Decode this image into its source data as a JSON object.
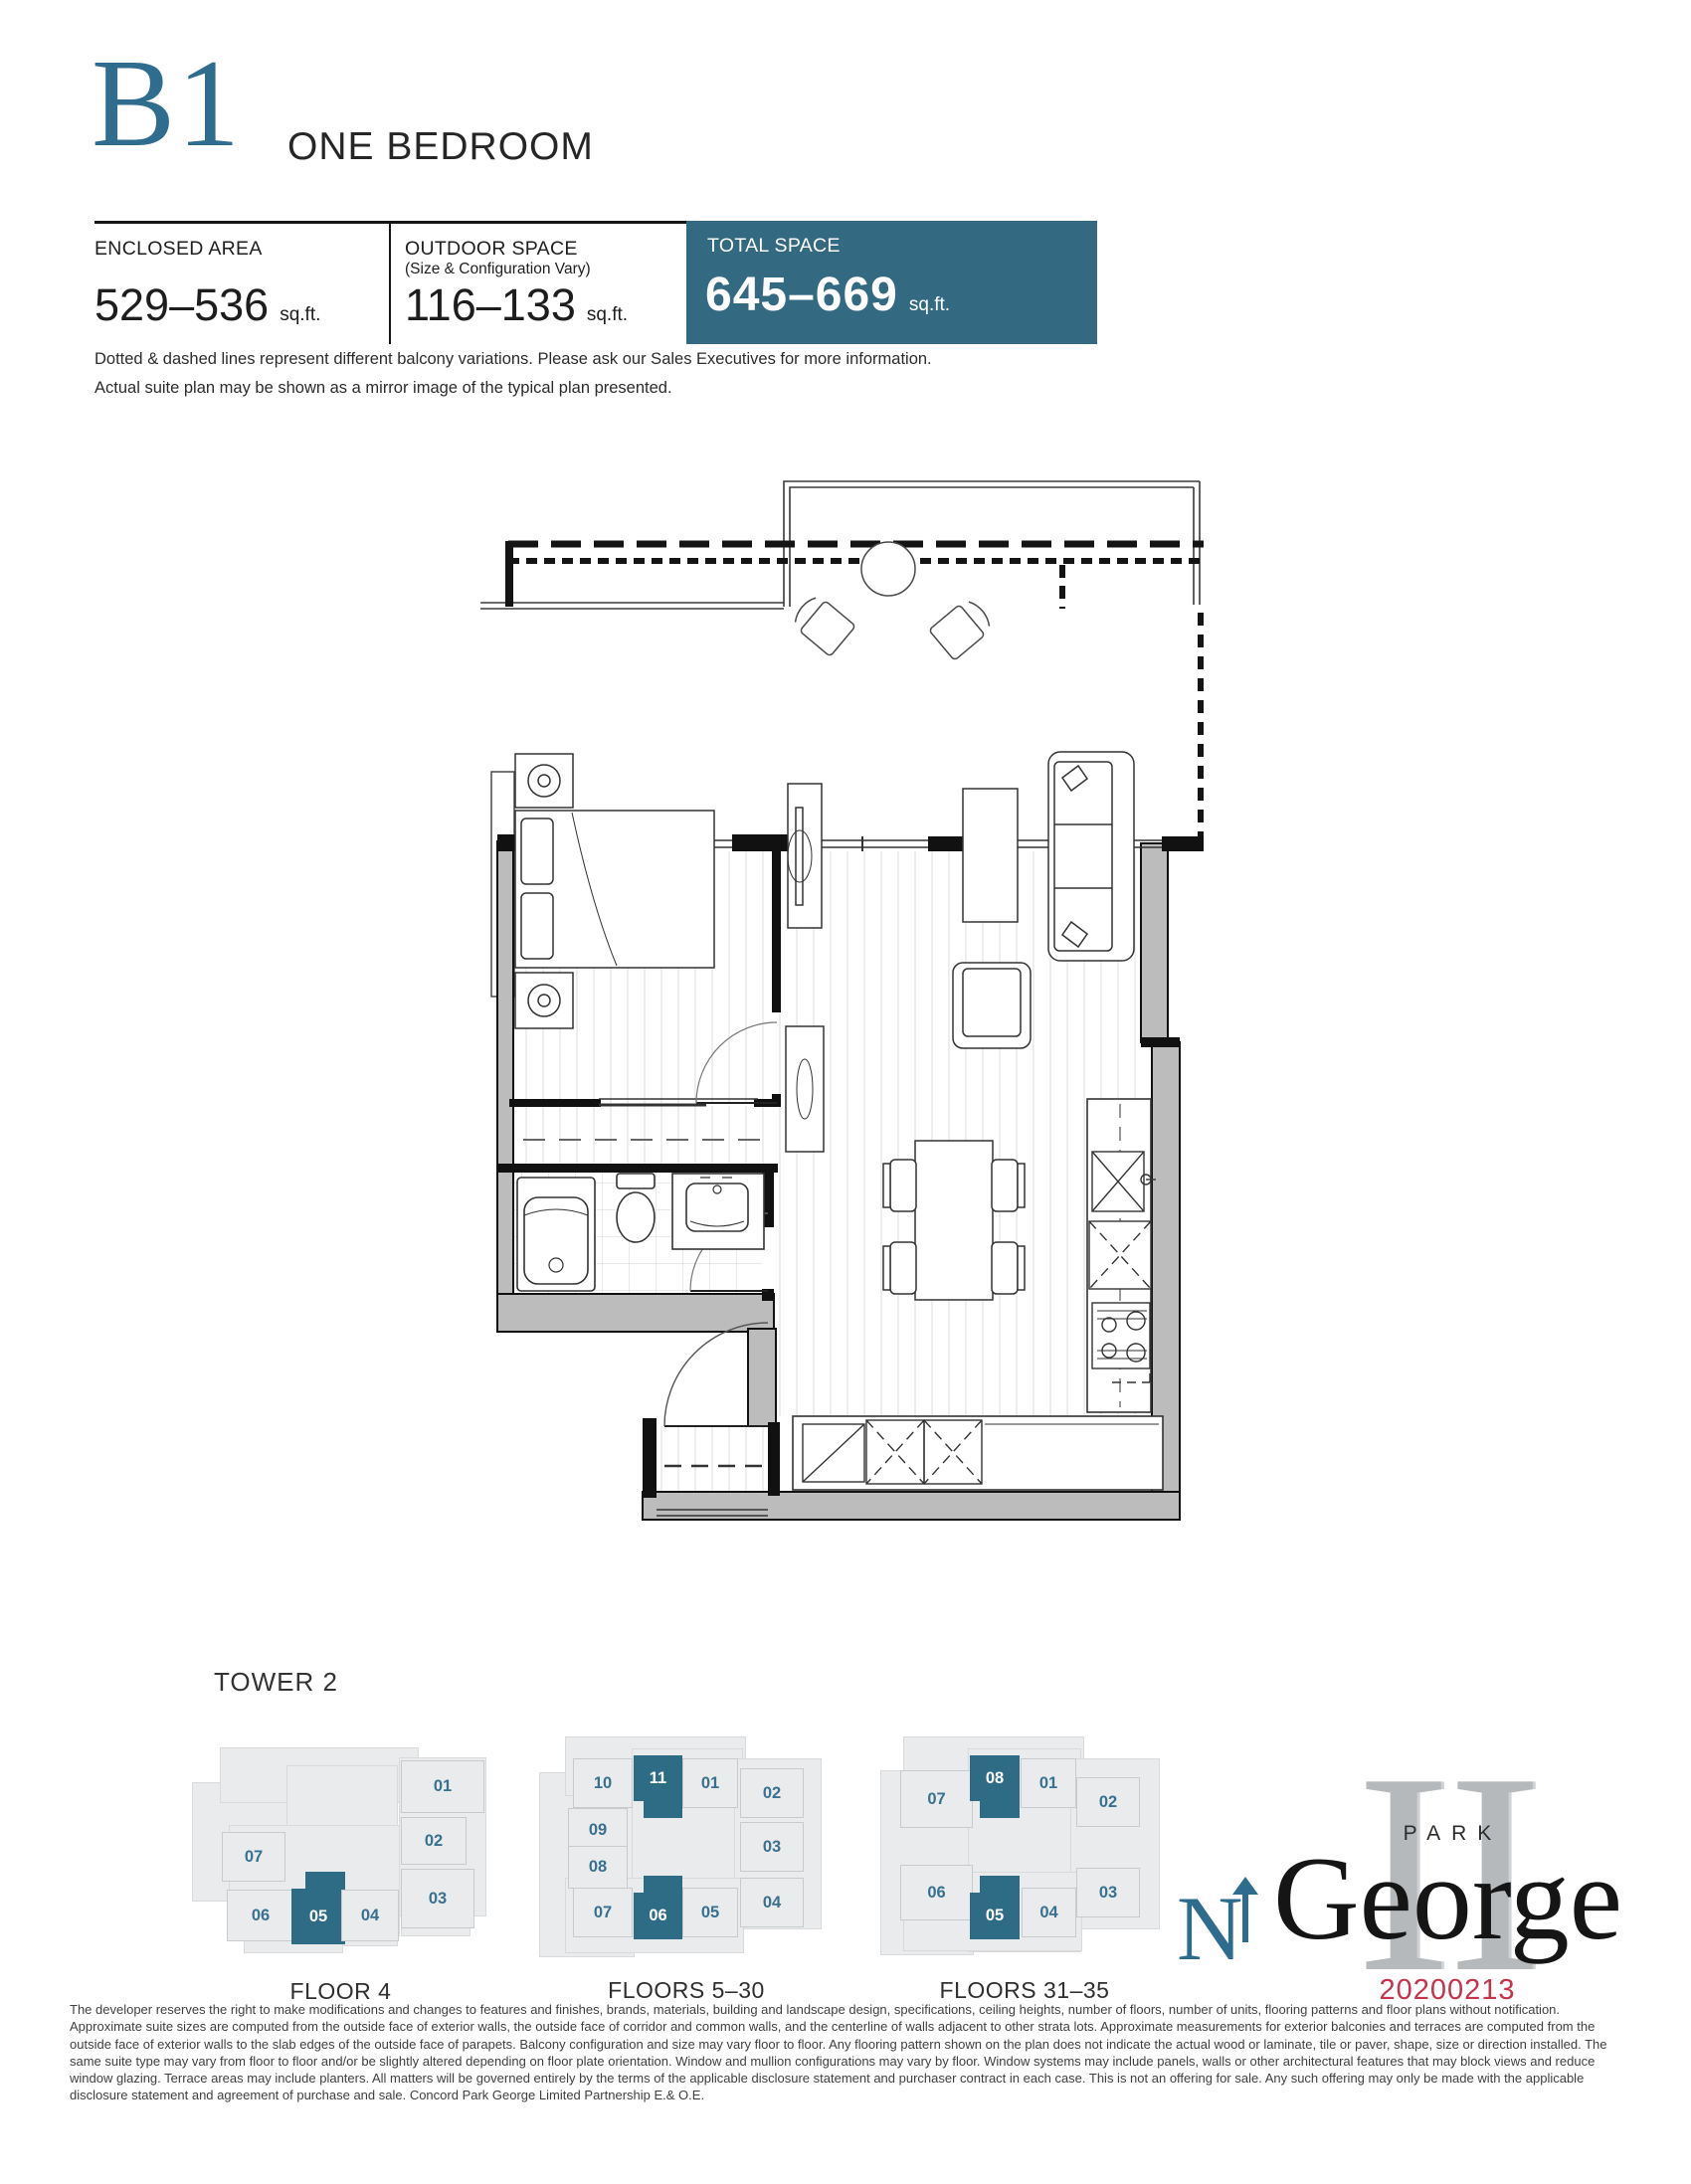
{
  "header": {
    "code": "B1",
    "type": "ONE BEDROOM"
  },
  "stats": {
    "enclosed": {
      "label": "ENCLOSED AREA",
      "value": "529–536",
      "unit": "sq.ft."
    },
    "outdoor": {
      "label": "OUTDOOR SPACE",
      "sublabel": "(Size & Configuration Vary)",
      "value": "116–133",
      "unit": "sq.ft."
    },
    "total": {
      "label": "TOTAL SPACE",
      "value": "645–669",
      "unit": "sq.ft."
    }
  },
  "notes": {
    "line1": "Dotted & dashed lines represent different balcony variations. Please ask our Sales Executives for more information.",
    "line2": "Actual suite plan may be shown as a mirror image of the typical plan presented."
  },
  "keyplans": {
    "title": "TOWER 2",
    "plans": [
      {
        "label": "FLOOR 4",
        "units": [
          {
            "id": "01",
            "highlight": false
          },
          {
            "id": "02",
            "highlight": false
          },
          {
            "id": "03",
            "highlight": false
          },
          {
            "id": "07",
            "highlight": false
          },
          {
            "id": "06",
            "highlight": false
          },
          {
            "id": "05",
            "highlight": true
          },
          {
            "id": "04",
            "highlight": false
          }
        ]
      },
      {
        "label": "FLOORS 5–30",
        "units": [
          {
            "id": "10",
            "highlight": false
          },
          {
            "id": "11",
            "highlight": true
          },
          {
            "id": "01",
            "highlight": false
          },
          {
            "id": "02",
            "highlight": false
          },
          {
            "id": "09",
            "highlight": false
          },
          {
            "id": "03",
            "highlight": false
          },
          {
            "id": "08",
            "highlight": false
          },
          {
            "id": "07",
            "highlight": false
          },
          {
            "id": "06",
            "highlight": true
          },
          {
            "id": "05",
            "highlight": false
          },
          {
            "id": "04",
            "highlight": false
          }
        ]
      },
      {
        "label": "FLOORS 31–35",
        "units": [
          {
            "id": "07",
            "highlight": false
          },
          {
            "id": "08",
            "highlight": true
          },
          {
            "id": "01",
            "highlight": false
          },
          {
            "id": "02",
            "highlight": false
          },
          {
            "id": "06",
            "highlight": false
          },
          {
            "id": "05",
            "highlight": true
          },
          {
            "id": "04",
            "highlight": false
          },
          {
            "id": "03",
            "highlight": false
          }
        ]
      }
    ]
  },
  "compass": {
    "label": "N"
  },
  "logo": {
    "numeral": "II",
    "park": "PARK",
    "george": "George",
    "date": "20200213"
  },
  "colors": {
    "accent_teal": "#336a82",
    "highlight_teal": "#2e6b85",
    "date_red": "#c5334d"
  },
  "legal": "The developer reserves the right to make modifications and changes to features and finishes, brands, materials, building and landscape design, specifications, ceiling heights, number of floors, number of units, flooring patterns and floor plans without notification. Approximate suite sizes are computed from the outside face of exterior walls, the outside face of corridor and common walls, and the centerline of walls adjacent to other strata lots. Approximate measurements for exterior balconies and terraces are computed from the outside face of exterior walls to the slab edges of the outside face of parapets. Balcony configuration and size may vary floor to floor. Any flooring pattern shown on the plan does not indicate the actual wood or laminate, tile or paver, shape, size or direction installed. The same suite type may vary from floor to floor and/or be slightly altered depending on floor plate orientation. Window and mullion configurations may vary by floor. Window systems may include panels, walls or other architectural features that may block views and reduce window glazing. Terrace areas may include planters. All matters will be governed entirely by the terms of the applicable disclosure statement and purchaser contract in each case. This is not an offering for sale. Any such offering may only be made with the applicable disclosure statement and agreement of purchase and sale. Concord Park George Limited Partnership E.& O.E."
}
